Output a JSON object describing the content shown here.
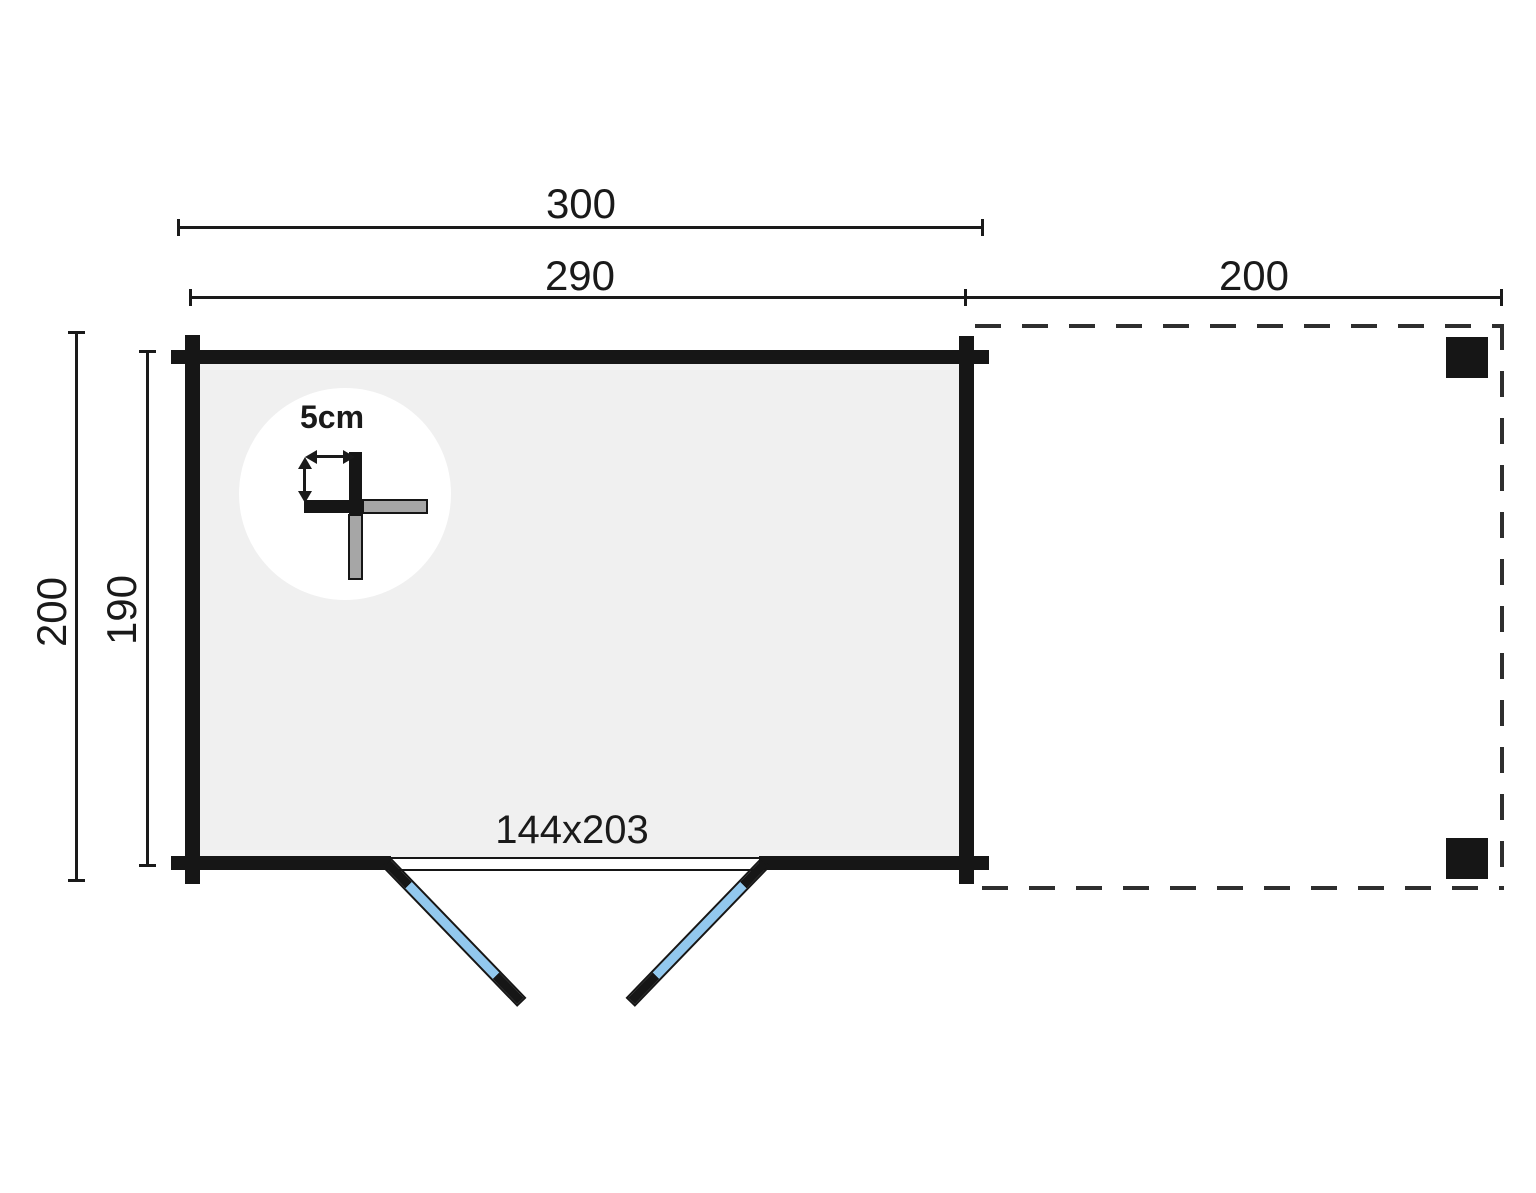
{
  "plan": {
    "top_dimensions": {
      "overall_width": "300",
      "cabin_width": "290",
      "canopy_width": "200"
    },
    "side_dimensions": {
      "overall_depth": "200",
      "cabin_depth": "190"
    },
    "door": {
      "size_label": "144x203"
    },
    "detail": {
      "wall_thickness_label": "5cm"
    },
    "colors": {
      "ink": "#1a1a1a",
      "wall": "#161616",
      "floor": "#f0f0f0",
      "door_blue": "#92c8ee",
      "log_gray": "#a6a6a6",
      "dash": "#2e2e2e",
      "bg": "#ffffff"
    }
  }
}
